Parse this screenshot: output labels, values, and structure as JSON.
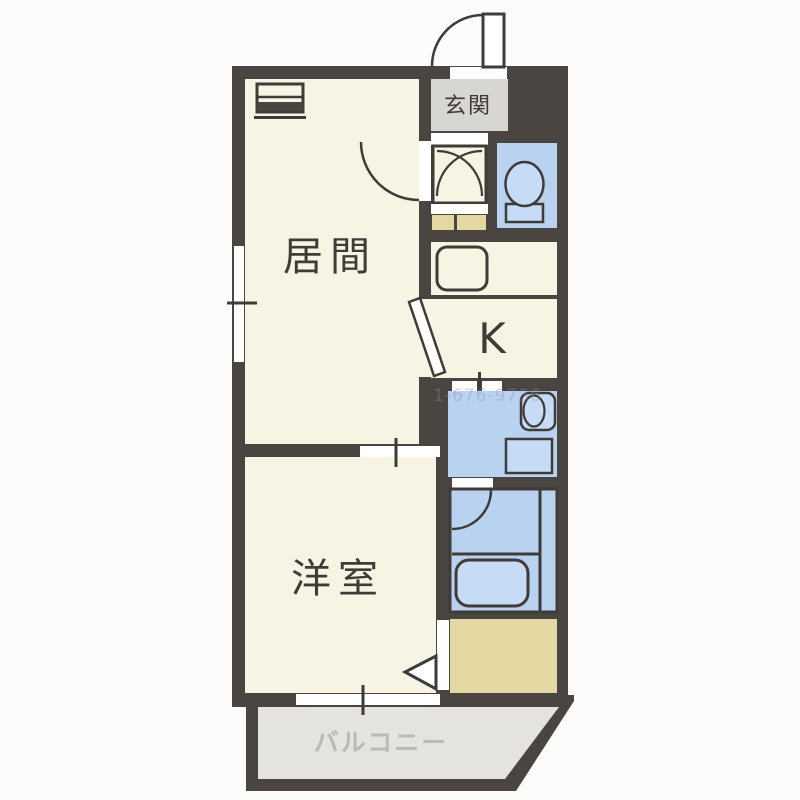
{
  "title": "apartment-floor-plan",
  "rooms": {
    "entrance": "玄関",
    "living": "居間",
    "kitchen": "K",
    "western_room": "洋室",
    "balcony": "バルコニー"
  },
  "watermark": "1-676-9736",
  "palette": {
    "wall": "#4a4541",
    "room_cream": "#f8f4e4",
    "entrance_gray": "#d8d6d3",
    "water_blue": "#b9d2f0",
    "fixture_blue": "#c6dbf5",
    "tatami_beige": "#e3d8a2",
    "balcony_gray": "#e4e3e0",
    "balcony_text": "#bcbab7",
    "line_dark": "#3f3b38",
    "background": "#fcfcfb",
    "watermark_color": "#8a93a8"
  }
}
